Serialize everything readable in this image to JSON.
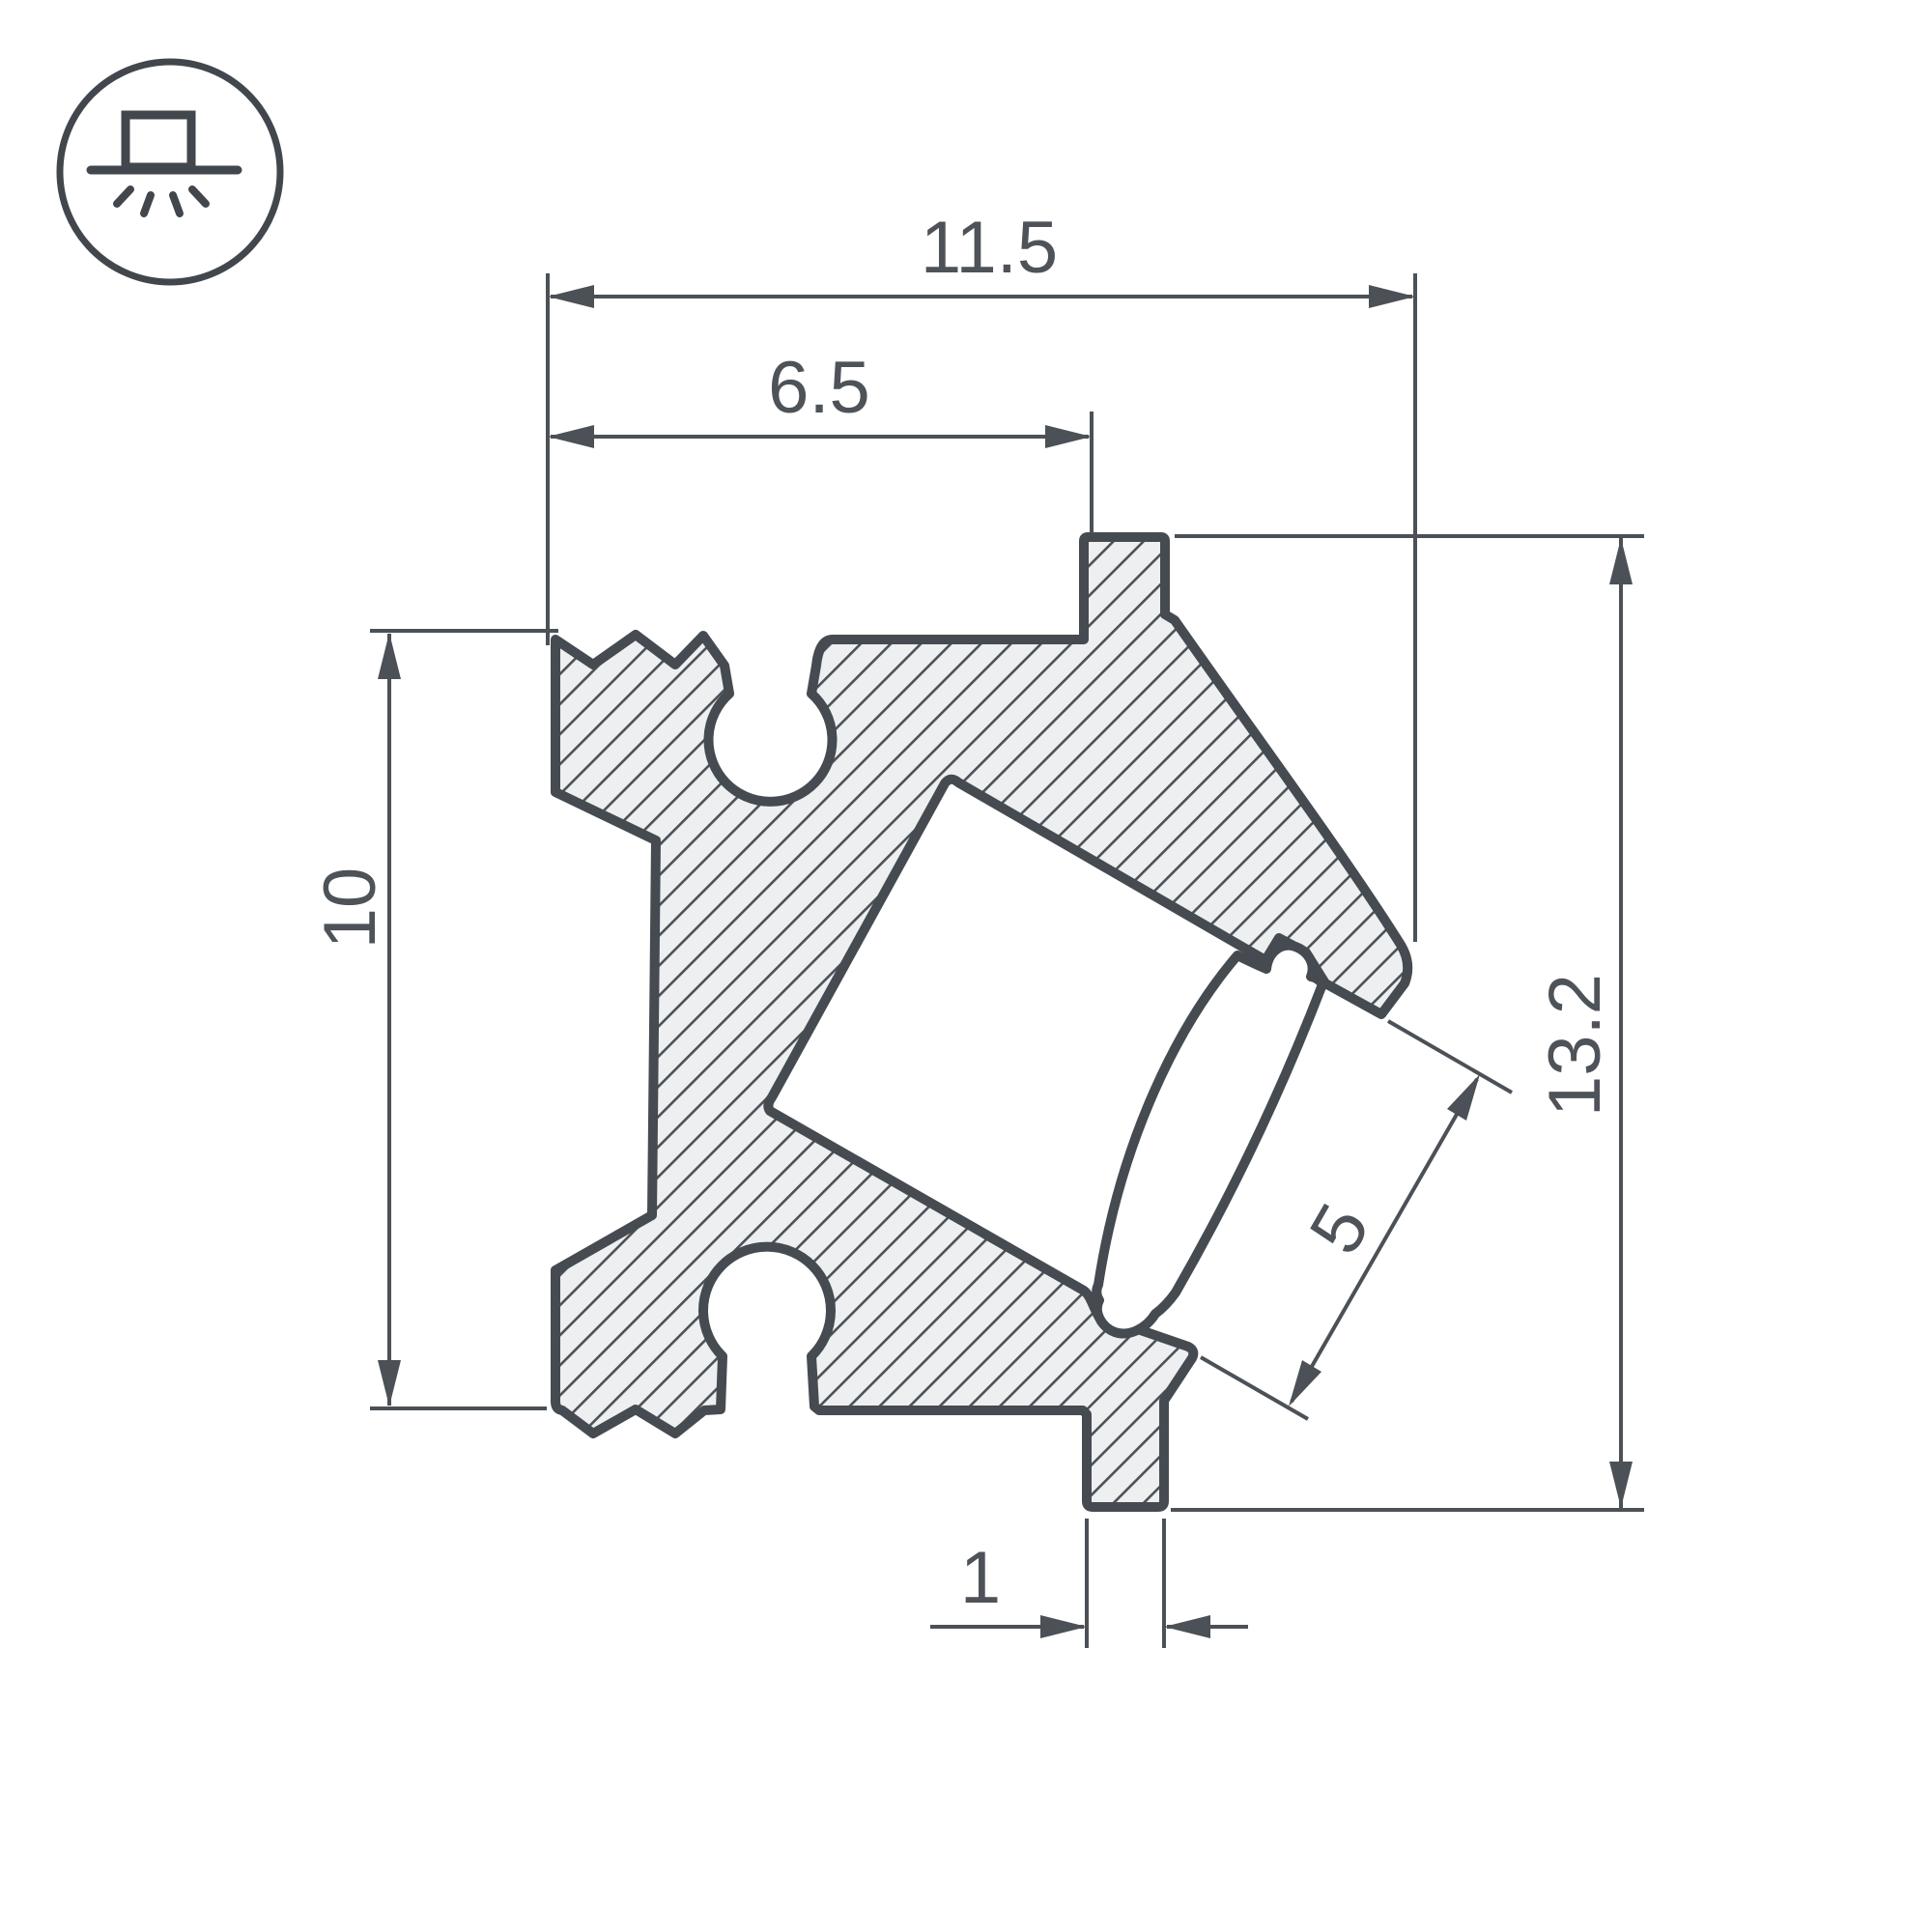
{
  "drawing": {
    "type": "profile-cross-section-technical-drawing",
    "background": "#ffffff",
    "colors": {
      "line": "#474d52",
      "hatch_fill": "#edeff0",
      "text": "#4d5358"
    },
    "icon": {
      "name": "surface-mount-light-icon"
    },
    "dimensions": {
      "overall_width": "11.5",
      "top_inner_width": "6.5",
      "left_height": "10",
      "right_height": "13.2",
      "led_opening": "5",
      "foot_width": "1"
    }
  }
}
